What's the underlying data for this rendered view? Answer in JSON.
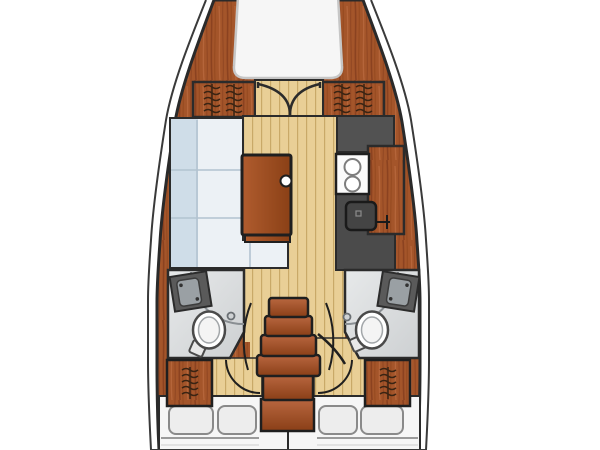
{
  "app": {
    "kind": "sailing-yacht-interior-floor-plan",
    "orientation": "bow-up",
    "visible_text": "none"
  },
  "palette": {
    "background": "#ffffff",
    "outline_dark": "#2b2b2b",
    "hull_wood": "#a4552a",
    "hull_wood_dark": "#8b4220",
    "hull_wood_light": "#b5653a",
    "floor_tan": "#e9cf96",
    "floor_plank_line": "#c9a968",
    "settee_blue": "#cfdde8",
    "settee_cushion": "#ecf1f5",
    "settee_line": "#b2c3d0",
    "galley_gray": "#525252",
    "galley_gray_deep": "#474747",
    "appliance_white": "#fbfbfb",
    "head_floor_light": "#e4e6e7",
    "head_floor": "#d2d5d7",
    "fixture_gray": "#5a5a5a",
    "basin_gray": "#9aa0a4",
    "berth_white": "#f6f6f6",
    "pillow_white": "#ededed",
    "pillow_edge": "#8a8a8a",
    "mattress_line": "#9a9a9a"
  },
  "rooms": [
    {
      "id": "v-berth",
      "label": "bow v-berth cabin"
    },
    {
      "id": "forward-bulkhead",
      "label": "forward bulkhead with double doors and hanging lockers"
    },
    {
      "id": "salon",
      "label": "main salon with port settee and table"
    },
    {
      "id": "galley",
      "label": "starboard galley with stove and sink"
    },
    {
      "id": "port-head",
      "label": "port bathroom with toilet, vanity and shower"
    },
    {
      "id": "starboard-head",
      "label": "starboard bathroom with toilet, vanity and shower"
    },
    {
      "id": "companionway",
      "label": "center companionway steps over engine box"
    },
    {
      "id": "aft-cabin-port",
      "label": "port aft double-berth cabin"
    },
    {
      "id": "aft-cabin-starboard",
      "label": "starboard aft double-berth cabin"
    }
  ],
  "fixtures": {
    "stove_burners": 2,
    "toilets": 2,
    "vanity_sinks": 2,
    "galley_sinks": 1,
    "companionway_steps": 5,
    "pillows": 4,
    "hanging_lockers": 4,
    "double_doors": 1,
    "table_knob": 1
  },
  "icons": {
    "toilet-icon": "white oval bowl with small tank block",
    "stove-icon": "white rectangle with two ring burners",
    "sink-icon": "rounded dark square with faucet tee",
    "shower-arc-icon": "quarter-circle curtain arc",
    "hanging-locker-icon": "rod with wavy hanger strokes",
    "door-swing-arc": "quarter-circle swing line",
    "double-door-arcs": "two facing quarter arcs",
    "table-knob": "small white circle on table edge"
  }
}
